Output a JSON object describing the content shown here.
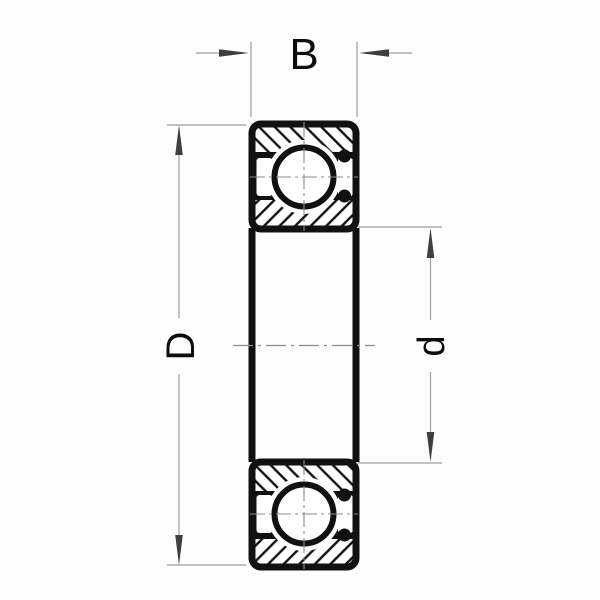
{
  "diagram": {
    "kind": "deep-groove-ball-bearing-cross-section",
    "dimension_labels": {
      "width": "B",
      "outer_diameter": "D",
      "bore_diameter": "d"
    },
    "colors": {
      "ink": "#111111",
      "dim_line": "#9b9b9b",
      "arrowhead": "#3f3f3f",
      "background": "#fdfdfd",
      "centerline": "#8a8a8a"
    }
  }
}
